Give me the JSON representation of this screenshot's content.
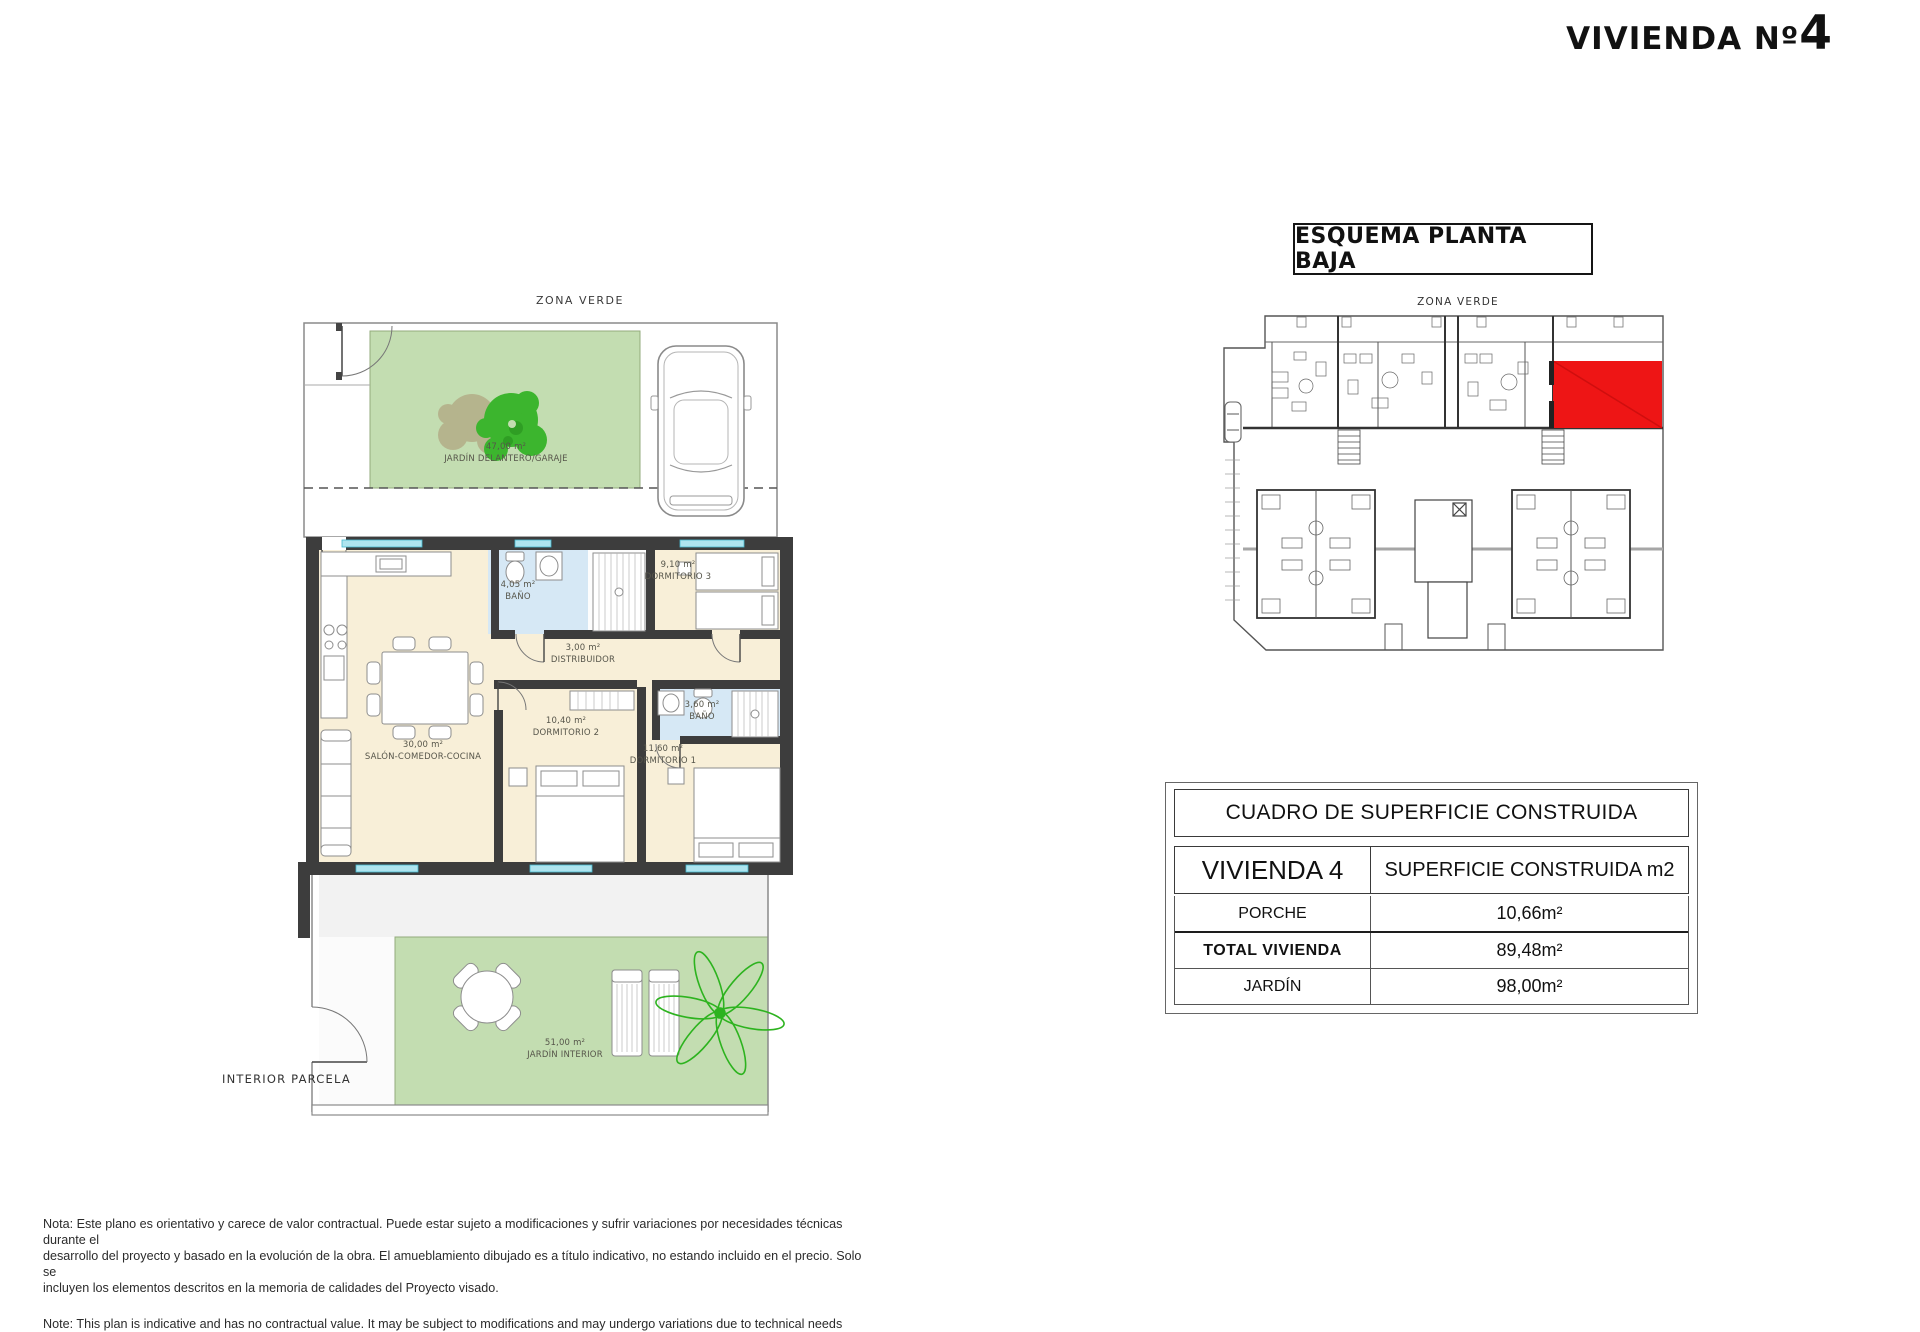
{
  "title": {
    "prefix": "VIVIENDA Nº",
    "number": "4"
  },
  "esquema": {
    "title": "ESQUEMA PLANTA BAJA",
    "zona_verde": "ZONA VERDE",
    "interior_parcela": "INTERIOR PARCELA"
  },
  "floor_plan": {
    "zona_verde": "ZONA VERDE",
    "interior_parcela": "INTERIOR PARCELA",
    "rooms": [
      {
        "area": "47,00 m²",
        "name": "JARDÍN DELANTERO/GARAJE"
      },
      {
        "area": "4,05 m²",
        "name": "BAÑO"
      },
      {
        "area": "9,10 m²",
        "name": "DORMITORIO 3"
      },
      {
        "area": "3,00 m²",
        "name": "DISTRIBUIDOR"
      },
      {
        "area": "30,00 m²",
        "name": "SALÓN-COMEDOR-COCINA"
      },
      {
        "area": "10,40 m²",
        "name": "DORMITORIO 2"
      },
      {
        "area": "3,60 m²",
        "name": "BAÑO"
      },
      {
        "area": "11,60 m²",
        "name": "DORMITORIO 1"
      },
      {
        "area": "51,00 m²",
        "name": "JARDÍN INTERIOR"
      }
    ]
  },
  "table": {
    "title": "CUADRO DE SUPERFICIE CONSTRUIDA",
    "col1_header": "VIVIENDA 4",
    "col2_header": "SUPERFICIE CONSTRUIDA m2",
    "rows": [
      {
        "label": "PORCHE",
        "value": "10,66m²"
      },
      {
        "label": "TOTAL  VIVIENDA",
        "value": "89,48m²"
      },
      {
        "label": "JARDÍN",
        "value": "98,00m²"
      }
    ]
  },
  "notes": {
    "es_line1": "Nota: Este plano es orientativo y carece de valor contractual. Puede estar sujeto a modificaciones y sufrir variaciones por necesidades técnicas durante el",
    "es_line2": "desarrollo del proyecto y basado en la evolución de la obra. El amueblamiento dibujado es a título indicativo, no estando incluido en el precio. Solo se",
    "es_line3": "incluyen los elementos descritos en la memoria de calidades del Proyecto visado.",
    "en_line": "Note: This plan is indicative and has no contractual value. It may be subject to modifications and may undergo variations due to technical needs"
  },
  "colors": {
    "wall": "#3d3d3d",
    "room_cream": "#f8efd8",
    "bath_blue": "#d6e8f5",
    "garden_green": "#c3ddb1",
    "plant_green": "#3cb52e",
    "highlight_red": "#ee1515",
    "window_cyan": "#aee4ef"
  }
}
